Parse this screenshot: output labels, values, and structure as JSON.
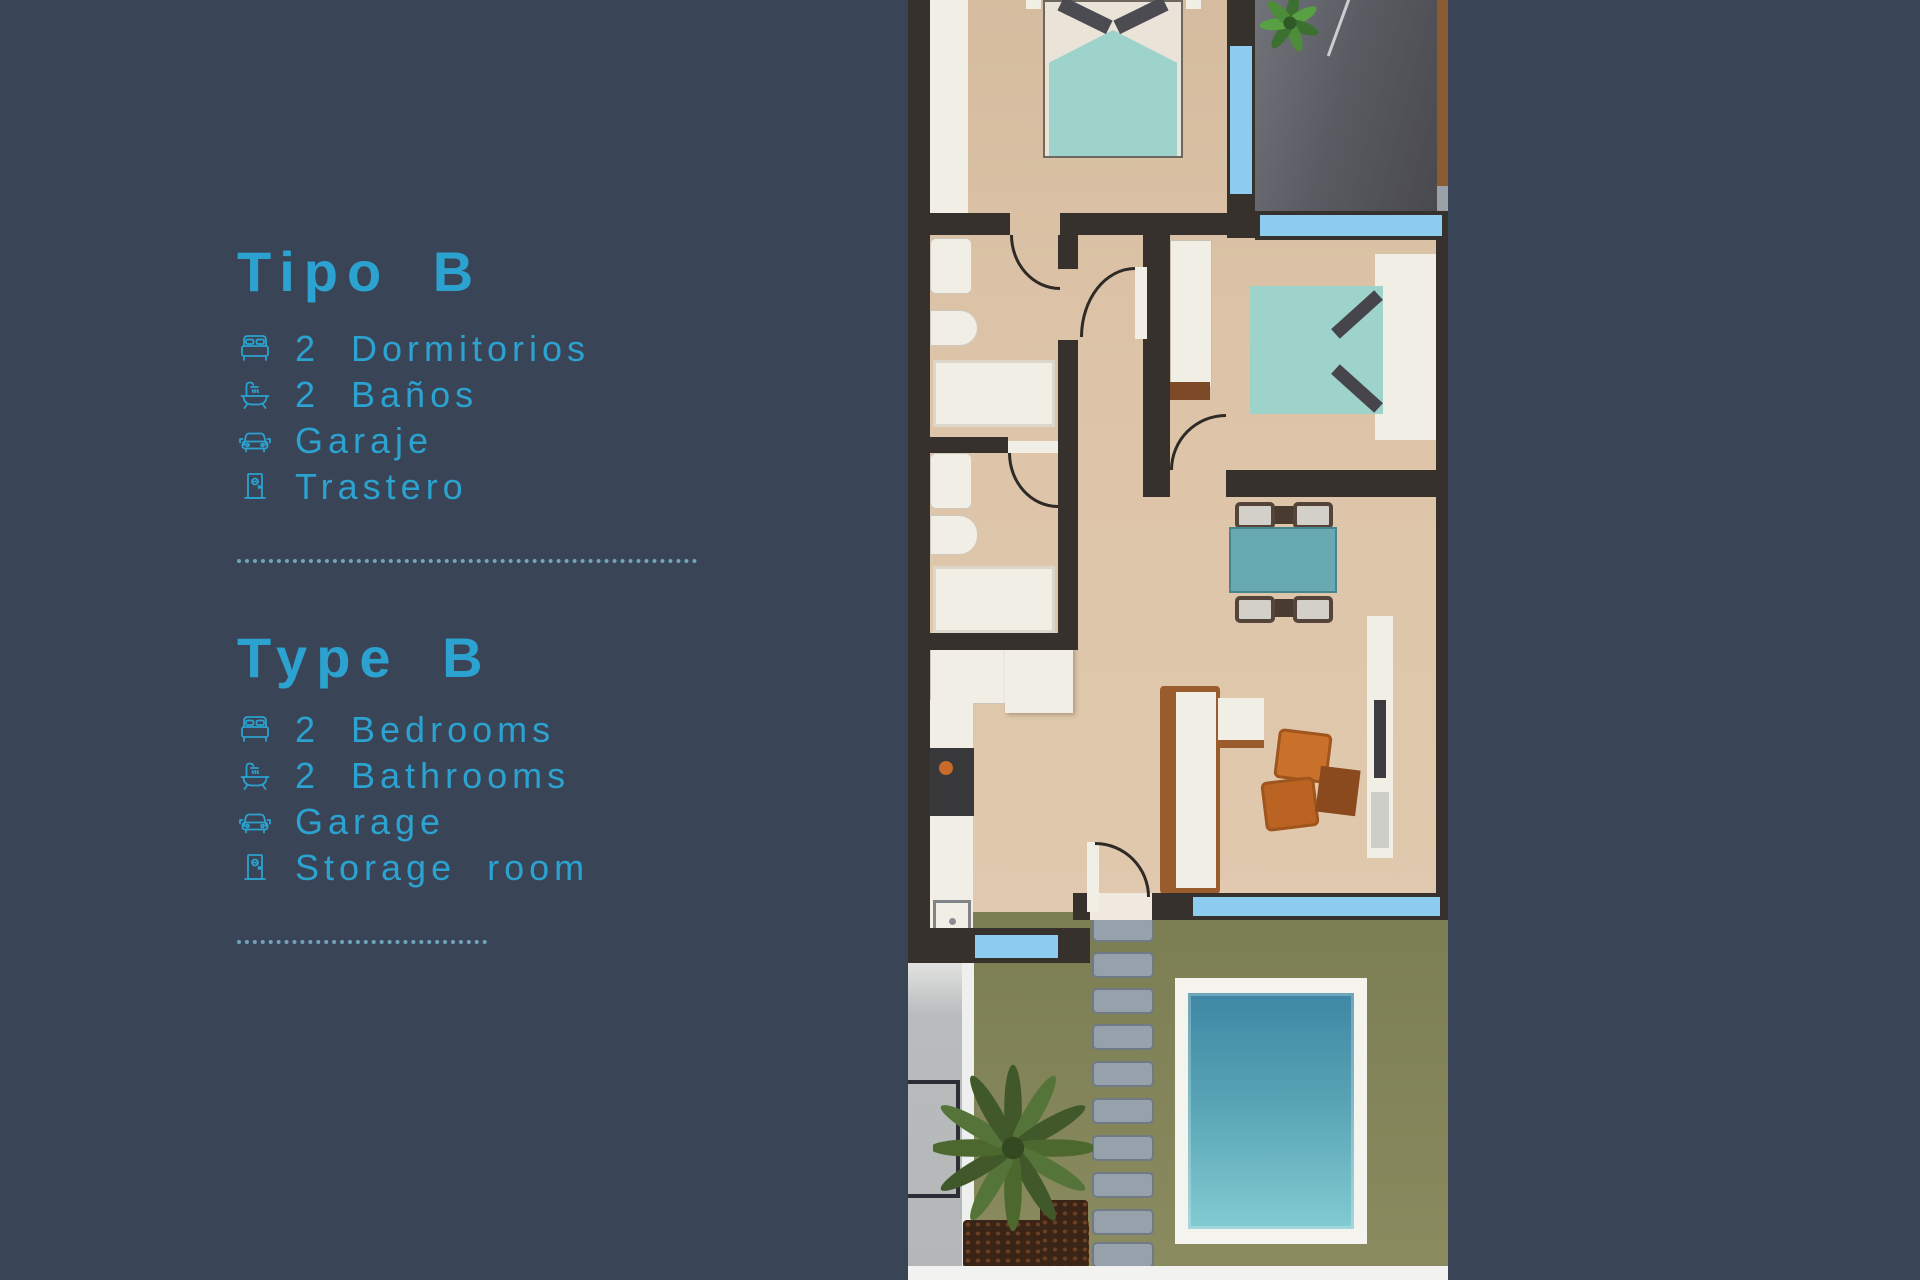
{
  "theme": {
    "background": "#3a4457",
    "accent": "#2ba2cf",
    "divider": "rgba(122,180,206,0.85)",
    "wall": "#37312d",
    "floor": "#dcc3a7",
    "window": "#8ccdef",
    "bed": "#9ed3cb",
    "table": "#68aab2",
    "garage_floor": "#5d5e65",
    "garden": "#82835a",
    "stone": "#97a1ab",
    "pool_deck": "#f5f3ed",
    "pool_top": "#3f87a4",
    "pool_bottom": "#82cbd2",
    "wood": "#9a5c2c",
    "armchair": "#c9712b"
  },
  "panel": {
    "sections": [
      {
        "id": "es",
        "heading": "Tipo B",
        "items": [
          {
            "icon": "bed-icon",
            "label": "2 Dormitorios"
          },
          {
            "icon": "bathtub-icon",
            "label": "2 Baños"
          },
          {
            "icon": "car-icon",
            "label": "Garaje"
          },
          {
            "icon": "door-icon",
            "label": "Trastero"
          }
        ]
      },
      {
        "id": "en",
        "heading": "Type B",
        "items": [
          {
            "icon": "bed-icon",
            "label": "2 Bedrooms"
          },
          {
            "icon": "bathtub-icon",
            "label": "2 Bathrooms"
          },
          {
            "icon": "car-icon",
            "label": "Garage"
          },
          {
            "icon": "door-icon",
            "label": "Storage room"
          }
        ]
      }
    ]
  },
  "floor_plan": {
    "alt": "Top-view rendered floor plan of a Type B home: master bedroom and garage at top, two bathrooms and second bedroom in the middle, kitchen and living-dining room below, private garden with stepping stones, palm tree and swimming pool at the bottom"
  }
}
